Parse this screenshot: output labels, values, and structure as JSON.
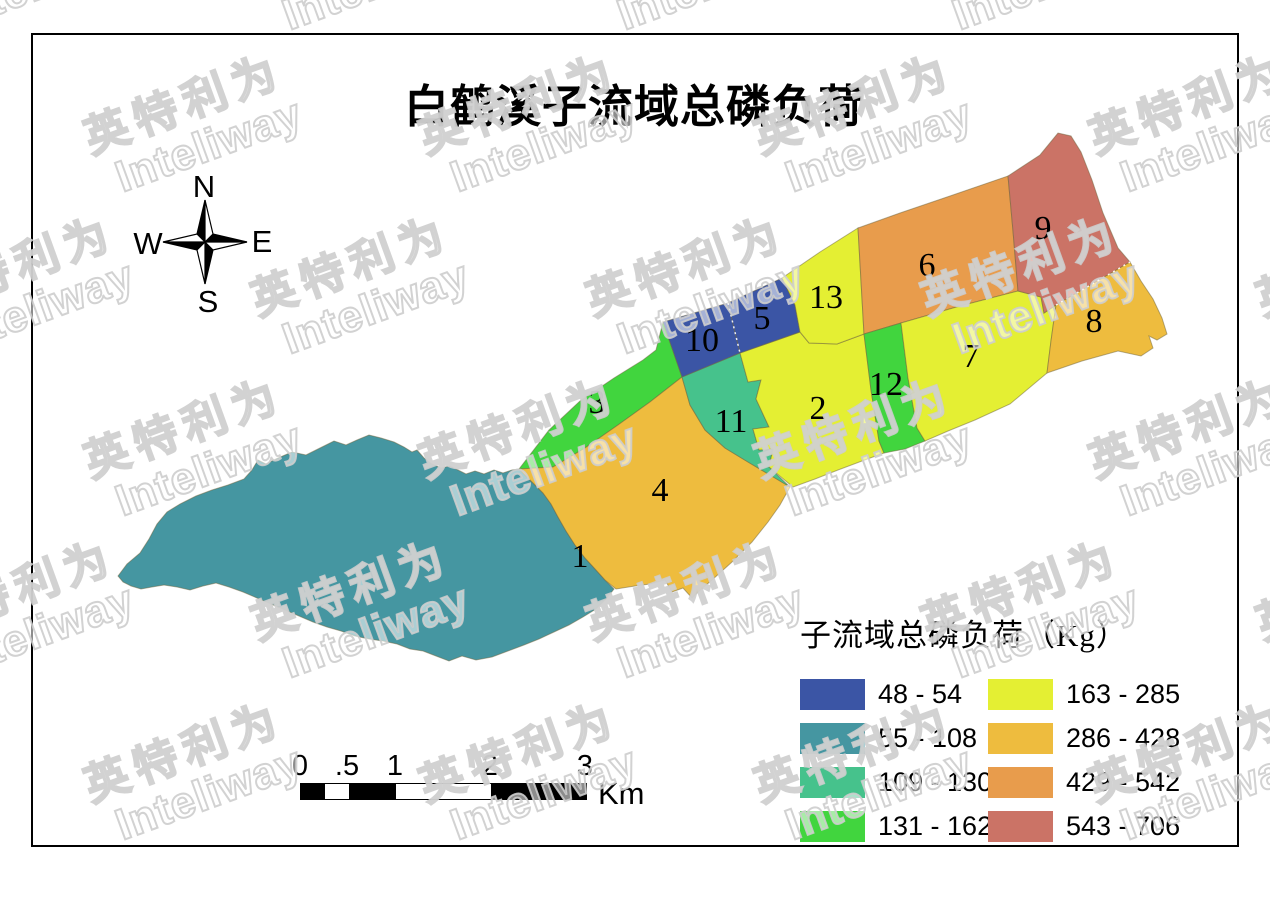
{
  "title": "白鹤溪子流域总磷负荷",
  "compass": {
    "n": "N",
    "e": "E",
    "s": "S",
    "w": "W"
  },
  "legend": {
    "title": "子流域总磷负荷（Kg）",
    "classes": [
      {
        "label": "48 - 54",
        "color": "#3B55A5"
      },
      {
        "label": "55 - 108",
        "color": "#4596A1"
      },
      {
        "label": "109 - 130",
        "color": "#46C28C"
      },
      {
        "label": "131 - 162",
        "color": "#41D53E"
      },
      {
        "label": "163 - 285",
        "color": "#E4EF33"
      },
      {
        "label": "286 - 428",
        "color": "#EEBC3E"
      },
      {
        "label": "429 - 542",
        "color": "#E89C4C"
      },
      {
        "label": "543 - 706",
        "color": "#CB7366"
      }
    ]
  },
  "scalebar": {
    "ticks": [
      "0",
      ".5",
      "1",
      "2",
      "3"
    ],
    "unit": "Km"
  },
  "map": {
    "regions": [
      {
        "id": "1",
        "class_index": 1
      },
      {
        "id": "2",
        "class_index": 4
      },
      {
        "id": "3",
        "class_index": 3
      },
      {
        "id": "4",
        "class_index": 5
      },
      {
        "id": "5",
        "class_index": 0
      },
      {
        "id": "6",
        "class_index": 6
      },
      {
        "id": "7",
        "class_index": 4
      },
      {
        "id": "8",
        "class_index": 5
      },
      {
        "id": "9",
        "class_index": 7
      },
      {
        "id": "10",
        "class_index": 0
      },
      {
        "id": "11",
        "class_index": 2
      },
      {
        "id": "12",
        "class_index": 3
      },
      {
        "id": "13",
        "class_index": 4
      }
    ]
  },
  "watermark": {
    "text_cn": "英特利为",
    "text_en": "Inteliway"
  }
}
